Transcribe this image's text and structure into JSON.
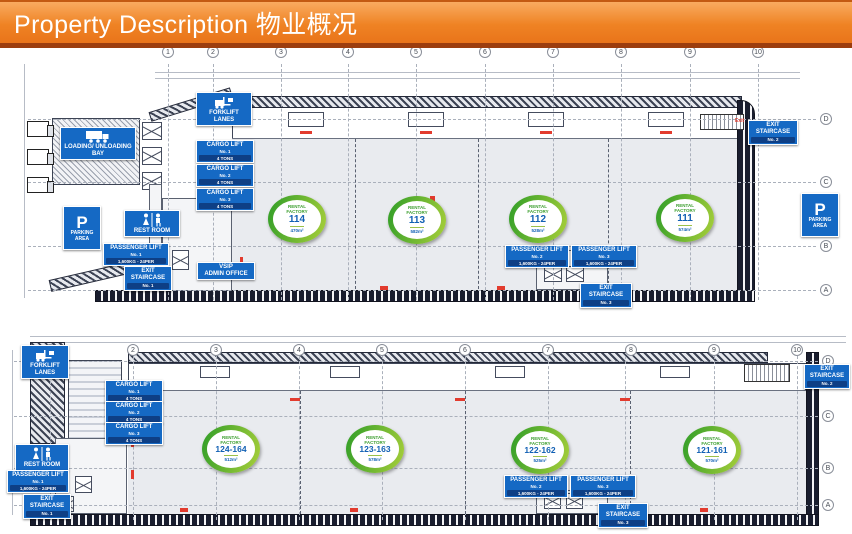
{
  "header": {
    "title": "Property Description 物业概况"
  },
  "colors": {
    "header_orange": "#ef8324",
    "header_strip": "#9c3d0e",
    "label_blue": "#1569c4",
    "label_band_blue": "#0e3f85",
    "badge_green": "#58b030",
    "number_blue": "#1160b4",
    "door_red": "#e23b2e"
  },
  "plan1": {
    "grid_cols": [
      "1",
      "2",
      "3",
      "4",
      "5",
      "6",
      "7",
      "8",
      "9",
      "10"
    ],
    "grid_rows": [
      "D",
      "C",
      "B",
      "A"
    ],
    "labels": {
      "forklift_lanes": "FORKLIFT LANES",
      "loading_bay": "LOADING/ UNLOADING BAY",
      "parking_p": "P",
      "parking": "PARKING AREA",
      "parking_right_p": "P",
      "parking_right": "PARKING AREA",
      "rest_room": "REST ROOM",
      "admin_line1": "VSIP",
      "admin_line2": "ADMIN OFFICE",
      "exit_small": "Exit"
    },
    "cargo_lifts": [
      {
        "title": "CARGO LIFT",
        "no": "No. 1",
        "capacity": "4 TONS"
      },
      {
        "title": "CARGO LIFT",
        "no": "No. 2",
        "capacity": "4 TONS"
      },
      {
        "title": "CARGO LIFT",
        "no": "No. 3",
        "capacity": "4 TONS"
      }
    ],
    "passenger_lifts": [
      {
        "title": "PASSENGER LIFT",
        "no": "No. 1",
        "capacity": "1,600KG - 24PER"
      },
      {
        "title": "PASSENGER LIFT",
        "no": "No. 2",
        "capacity": "1,600KG - 24PER"
      },
      {
        "title": "PASSENGER LIFT",
        "no": "No. 3",
        "capacity": "1,600KG - 24PER"
      }
    ],
    "exit_staircases": [
      {
        "title": "EXIT STAIRCASE",
        "no": "No. 1"
      },
      {
        "title": "EXIT STAIRCASE",
        "no": "No. 2"
      },
      {
        "title": "EXIT STAIRCASE",
        "no": "No. 3"
      }
    ],
    "factories": [
      {
        "title": "RENTAL FACTORY",
        "unit": "114",
        "area": "470m²"
      },
      {
        "title": "RENTAL FACTORY",
        "unit": "113",
        "area": "582m²"
      },
      {
        "title": "RENTAL FACTORY",
        "unit": "112",
        "area": "528m²"
      },
      {
        "title": "RENTAL FACTORY",
        "unit": "111",
        "area": "574m²"
      }
    ]
  },
  "plan2": {
    "grid_cols": [
      "1",
      "2",
      "3",
      "4",
      "5",
      "6",
      "7",
      "8",
      "9",
      "10"
    ],
    "grid_rows": [
      "D",
      "C",
      "B",
      "A"
    ],
    "labels": {
      "forklift_lanes": "FORKLIFT LANES",
      "rest_room": "REST ROOM"
    },
    "cargo_lifts": [
      {
        "title": "CARGO LIFT",
        "no": "No. 1",
        "capacity": "4 TONS"
      },
      {
        "title": "CARGO LIFT",
        "no": "No. 2",
        "capacity": "4 TONS"
      },
      {
        "title": "CARGO LIFT",
        "no": "No. 3",
        "capacity": "4 TONS"
      }
    ],
    "passenger_lifts": [
      {
        "title": "PASSENGER LIFT",
        "no": "No. 1",
        "capacity": "1,600KG - 24PER"
      },
      {
        "title": "PASSENGER LIFT",
        "no": "No. 2",
        "capacity": "1,600KG - 24PER"
      },
      {
        "title": "PASSENGER LIFT",
        "no": "No. 3",
        "capacity": "1,600KG - 24PER"
      }
    ],
    "exit_staircases": [
      {
        "title": "EXIT STAIRCASE",
        "no": "No. 1"
      },
      {
        "title": "EXIT STAIRCASE",
        "no": "No. 2"
      },
      {
        "title": "EXIT STAIRCASE",
        "no": "No. 3"
      }
    ],
    "factories": [
      {
        "title": "RENTAL FACTORY",
        "unit": "124-164",
        "area": "512m²"
      },
      {
        "title": "RENTAL FACTORY",
        "unit": "123-163",
        "area": "578m²"
      },
      {
        "title": "RENTAL FACTORY",
        "unit": "122-162",
        "area": "525m²"
      },
      {
        "title": "RENTAL FACTORY",
        "unit": "121-161",
        "area": "570m²"
      }
    ]
  }
}
